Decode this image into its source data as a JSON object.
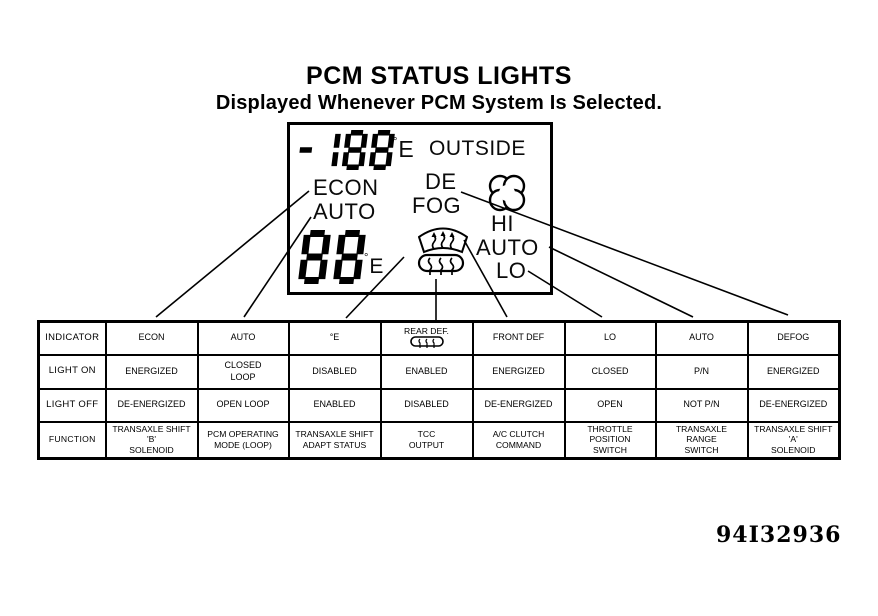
{
  "title": "PCM STATUS LIGHTS",
  "subtitle": "Displayed Whenever PCM System Is Selected.",
  "figure_number": "94I32936",
  "display": {
    "outside_temp_value": "-188",
    "outside_temp_unit": {
      "deg": "°",
      "letter": "E"
    },
    "outside_label": "OUTSIDE",
    "econ_label": "ECON",
    "auto_left_label": "AUTO",
    "defog_line1": "DE",
    "defog_line2": "FOG",
    "fan_hi_label": "HI",
    "fan_auto_label": "AUTO",
    "fan_lo_label": "LO",
    "setting_value": "88",
    "setting_unit": {
      "deg": "°",
      "letter": "E"
    },
    "icons": [
      "fan-icon",
      "front-defrost-icon",
      "rear-defog-icon"
    ]
  },
  "table": {
    "rows": [
      {
        "header": "INDICATOR",
        "cells": [
          "ECON",
          "AUTO",
          "°E",
          {
            "text": "REAR DEF.",
            "icon": "rear-defog-icon-small"
          },
          "FRONT DEF",
          "LO",
          "AUTO",
          "DEFOG"
        ]
      },
      {
        "header": "LIGHT ON",
        "cells": [
          "ENERGIZED",
          "CLOSED\nLOOP",
          "DISABLED",
          "ENABLED",
          "ENERGIZED",
          "CLOSED",
          "P/N",
          "ENERGIZED"
        ]
      },
      {
        "header": "LIGHT OFF",
        "cells": [
          "DE-ENERGIZED",
          "OPEN LOOP",
          "ENABLED",
          "DISABLED",
          "DE-ENERGIZED",
          "OPEN",
          "NOT P/N",
          "DE-ENERGIZED"
        ]
      },
      {
        "header": "FUNCTION",
        "cells": [
          "TRANSAXLE SHIFT\n'B'\nSOLENOID",
          "PCM OPERATING\nMODE (LOOP)",
          "TRANSAXLE SHIFT\nADAPT STATUS",
          "TCC\nOUTPUT",
          "A/C CLUTCH\nCOMMAND",
          "THROTTLE\nPOSITION\nSWITCH",
          "TRANSAXLE\nRANGE\nSWITCH",
          "TRANSAXLE SHIFT\n'A'\nSOLENOID"
        ]
      }
    ]
  }
}
